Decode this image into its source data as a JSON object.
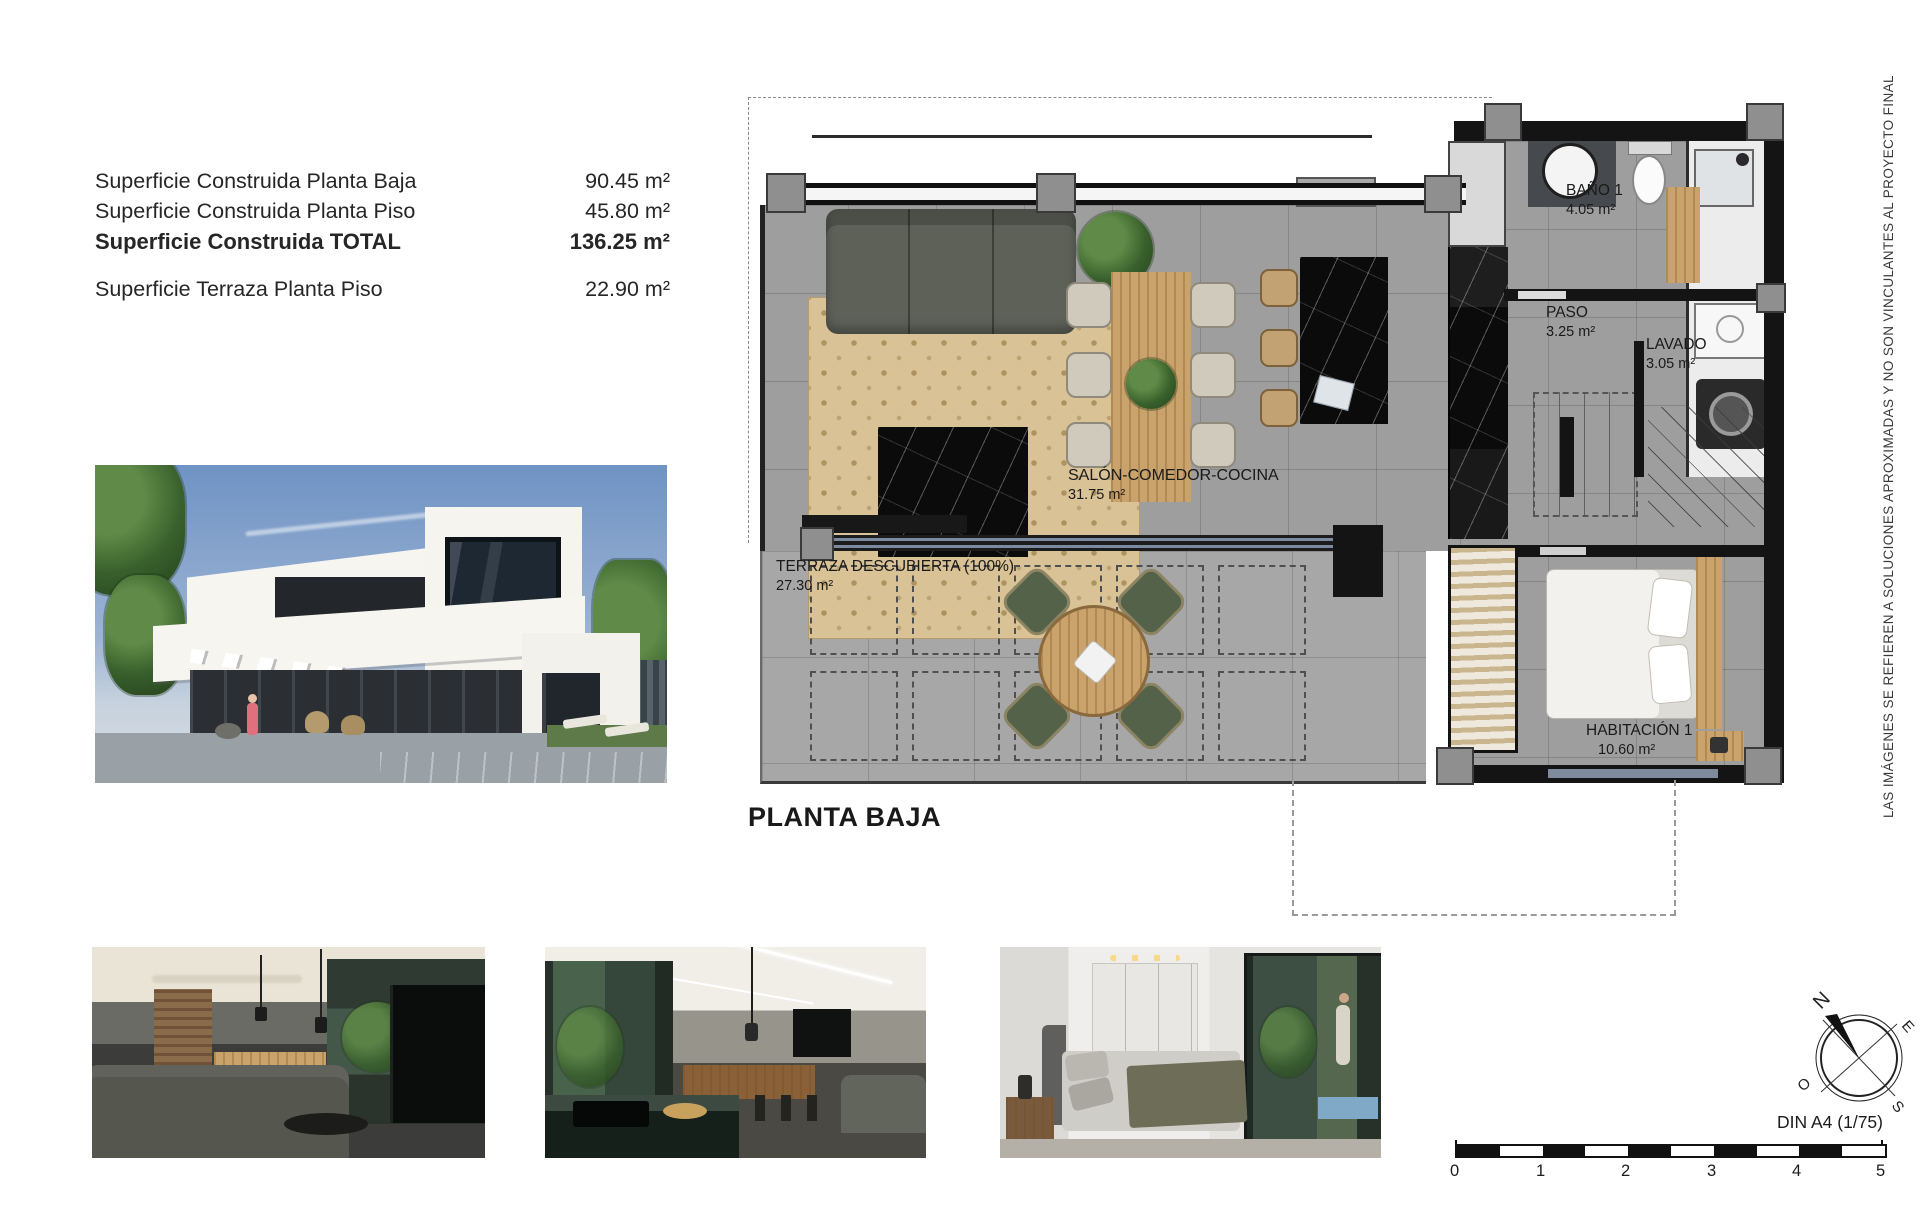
{
  "summary": {
    "rows": [
      {
        "label": "Superficie Construida Planta Baja",
        "value": "90.45 m²"
      },
      {
        "label": "Superficie Construida Planta Piso",
        "value": "45.80 m²"
      },
      {
        "label": "Superficie Construida TOTAL",
        "value": "136.25 m²"
      },
      {
        "label": "Superficie Terraza Planta Piso",
        "value": "22.90 m²"
      }
    ]
  },
  "plan": {
    "title": "PLANTA BAJA",
    "rooms": {
      "salon": {
        "name": "SALÓN-COMEDOR-COCINA",
        "area": "31.75 m²"
      },
      "terraza": {
        "name": "TERRAZA DESCUBIERTA (100%)",
        "area": "27.30 m²"
      },
      "bano": {
        "name": "BAÑO 1",
        "area": "4.05 m²"
      },
      "paso": {
        "name": "PASO",
        "area": "3.25 m²"
      },
      "lavado": {
        "name": "LAVADO",
        "area": "3.05 m²"
      },
      "habitacion": {
        "name": "HABITACIÓN 1",
        "area": "10.60 m²"
      }
    }
  },
  "compass": {
    "north": "N",
    "east": "E",
    "south": "S",
    "west": "O"
  },
  "scalebar": {
    "label": "DIN A4 (1/75)",
    "ticks": [
      "0",
      "1",
      "2",
      "3",
      "4",
      "5"
    ]
  },
  "disclaimer": "LAS IMÁGENES SE REFIEREN A SOLUCIONES APROXIMADAS Y NO SON VINCULANTES AL PROYECTO FINAL",
  "colors": {
    "floor_tile": "#9e9e9e",
    "terrace_tile": "#a7a7a7",
    "wall": "#141414",
    "rug": "#d8c296",
    "wood": "#c9a36b",
    "marble": "#0b0b0b",
    "pool": "#6fa6c9",
    "sky": "#7a9cc9"
  }
}
